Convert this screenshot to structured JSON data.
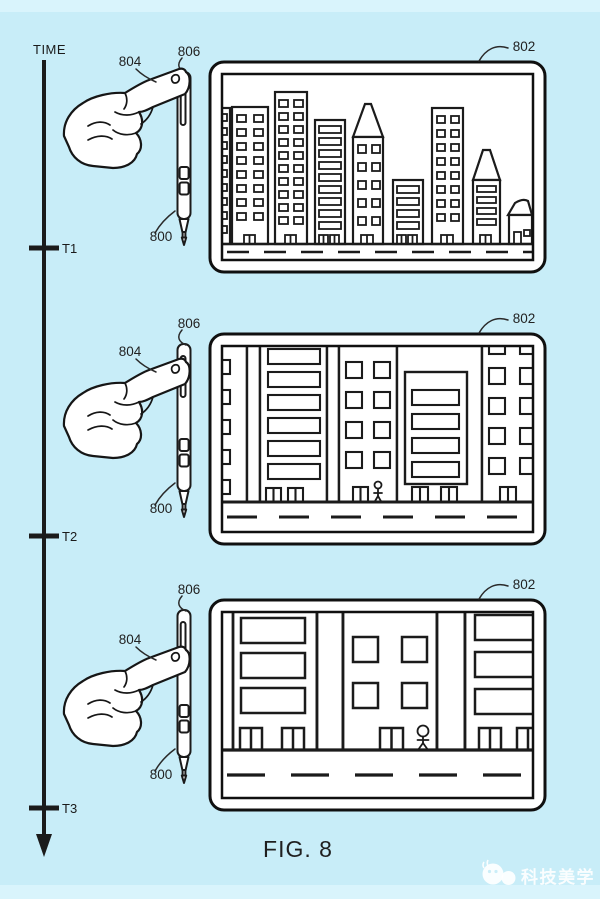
{
  "figure_label": "FIG. 8",
  "timeline": {
    "axis_label": "TIME",
    "ticks": [
      {
        "label": "T1"
      },
      {
        "label": "T2"
      },
      {
        "label": "T3"
      }
    ]
  },
  "refs": {
    "pen": "800",
    "screen": "802",
    "hand": "804",
    "pen_top_control": "806"
  },
  "scenes": {
    "t1": "city-skyline-zoomed-out",
    "t2": "city-buildings-mid-zoom",
    "t3": "city-buildings-close-zoom"
  },
  "watermark": {
    "text": "科技美学"
  },
  "colors": {
    "background": "#c8edf8",
    "edge_strip": "#d9f4fc",
    "ink": "#1b1b1b",
    "watermark_text": "#ffffff"
  }
}
